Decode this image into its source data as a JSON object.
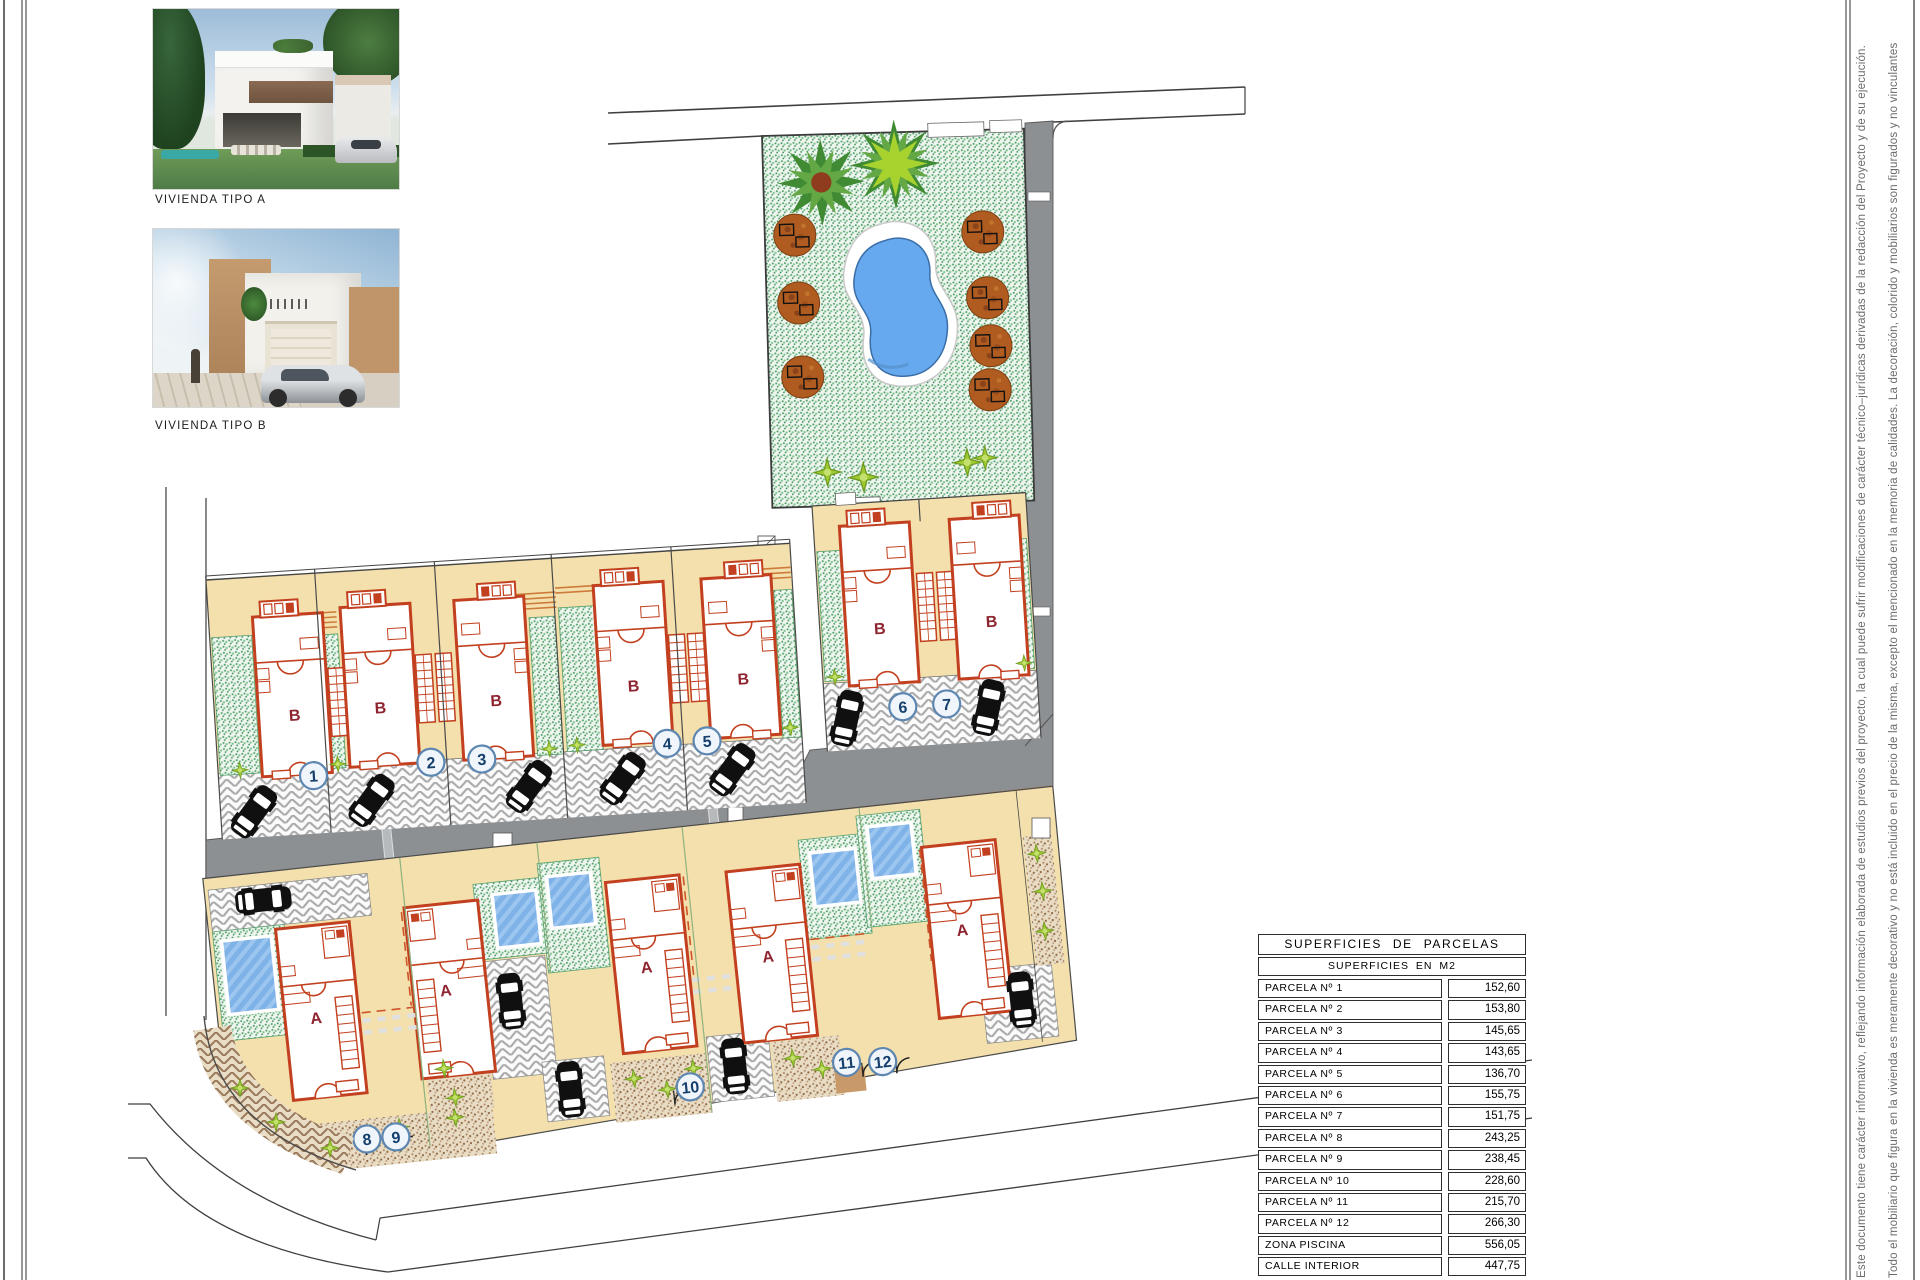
{
  "photos": {
    "a": {
      "caption": "VIVIENDA TIPO  A"
    },
    "b": {
      "caption": "VIVIENDA TIPO  B"
    }
  },
  "plan": {
    "parcels": [
      "1",
      "2",
      "3",
      "4",
      "5",
      "6",
      "7",
      "8",
      "9",
      "10",
      "11",
      "12"
    ],
    "houses": [
      "B",
      "B",
      "B",
      "B",
      "B",
      "B",
      "B",
      "A",
      "A",
      "A",
      "A",
      "A"
    ]
  },
  "table": {
    "title": "SUPERFICIES  DE  PARCELAS",
    "subtitle": "SUPERFICIES  EN  M2",
    "rows": [
      {
        "label": "PARCELA  Nº  1",
        "value": "152,60"
      },
      {
        "label": "PARCELA  Nº  2",
        "value": "153,80"
      },
      {
        "label": "PARCELA  Nº  3",
        "value": "145,65"
      },
      {
        "label": "PARCELA  Nº  4",
        "value": "143,65"
      },
      {
        "label": "PARCELA  Nº  5",
        "value": "136,70"
      },
      {
        "label": "PARCELA  Nº  6",
        "value": "155,75"
      },
      {
        "label": "PARCELA  Nº  7",
        "value": "151,75"
      },
      {
        "label": "PARCELA  Nº  8",
        "value": "243,25"
      },
      {
        "label": "PARCELA  Nº  9",
        "value": "238,45"
      },
      {
        "label": "PARCELA  Nº  10",
        "value": "228,60"
      },
      {
        "label": "PARCELA  Nº  11",
        "value": "215,70"
      },
      {
        "label": "PARCELA  Nº  12",
        "value": "266,30"
      },
      {
        "label": "ZONA  PISCINA",
        "value": "556,05"
      },
      {
        "label": "CALLE  INTERIOR",
        "value": "447,75"
      }
    ],
    "total_label": "TOTAL:",
    "total_value": "3.236,00"
  },
  "notes": {
    "line1": "Este documento tiene carácter informativo, reflejando información elaborada de estudios previos del proyecto, la cual puede sufrir modificaciones de carácter técnico–jurídicas derivadas de la redacción del Proyecto y de su ejecución.",
    "line2": "Todo el mobiliario que figura en la vivienda es meramente decorativo y no está incluido en el precio de la misma, excepto el mencionado en la memoria de calidades. La decoración, colorido y mobiliarios son figurados y no vinculantes"
  },
  "colors": {
    "parcel_beige": "#f4e0ac",
    "road_gray": "#8d9093",
    "house_red": "#c2401f",
    "pool_blue": "#66a9ee",
    "garden_green": "#7cc18e",
    "circle_ring": "#5d86b0"
  }
}
